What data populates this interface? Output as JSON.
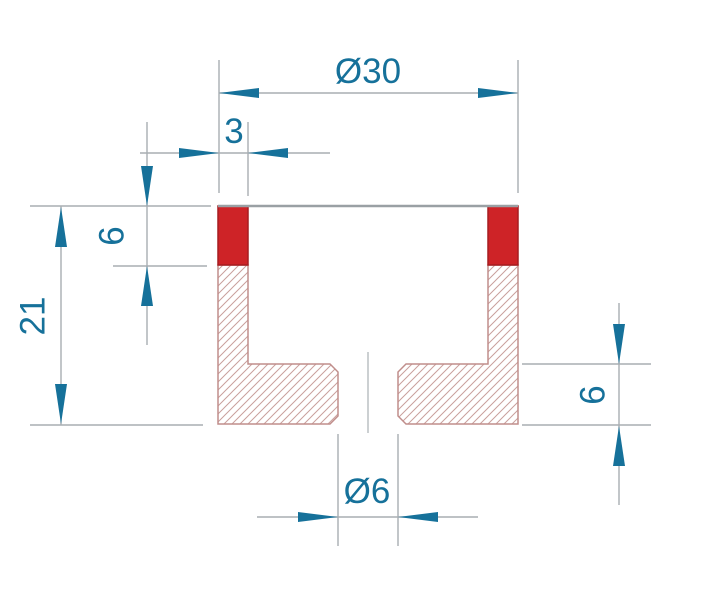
{
  "drawing": {
    "colors": {
      "accent": "#16719a",
      "line_gray": "#a9aeb2",
      "face_gray": "#9aa0a4",
      "outline_rose": "#c08e8b",
      "hatch": "#c99f9c",
      "centerline": "#9aa0a4",
      "red": "#ce2327",
      "red_border": "#a61d20",
      "background": "#ffffff"
    },
    "dimensions": {
      "outer_diameter": {
        "label": "Ø30",
        "value": 30
      },
      "wall_thickness": {
        "label": "3",
        "value": 3
      },
      "rim_height": {
        "label": "6",
        "value": 6
      },
      "overall_height": {
        "label": "21",
        "value": 21
      },
      "base_thickness": {
        "label": "6",
        "value": 6
      },
      "bore_diameter": {
        "label": "Ø6",
        "value": 6
      }
    }
  }
}
